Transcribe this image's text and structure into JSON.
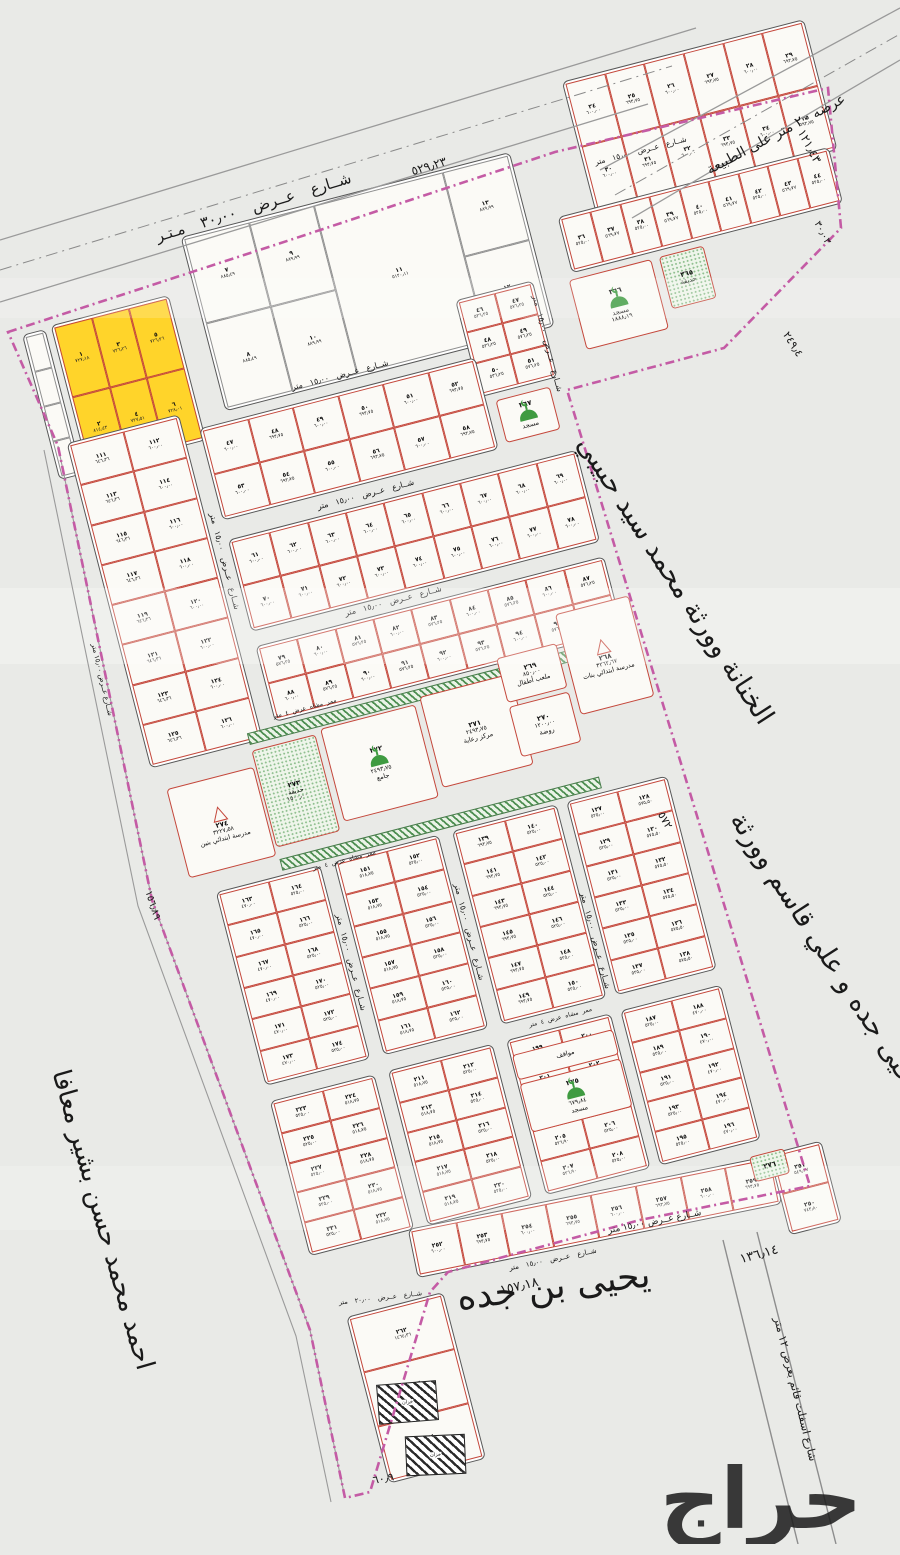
{
  "map": {
    "street30": "شــارع عــرض ٣٠٫٠٠ مـتـر",
    "street30_len": "٥٢٩٫٢٣",
    "street15": "شــارع عــرض ١٥٫٠٠ متر",
    "street20": "شــارع عــرض ٢٠٫٠٠ متر",
    "nature_road": "عرضه ٢٠ متر على الطبيعة",
    "asphalt_road": "شارع اسفلت قائم بعرض ١٢ متر",
    "walkway": "ممر مشاه عرض ٤ متر",
    "owner_right_1": "الخنانة وورثة محمد سيد حبيبي",
    "owner_right_2": "ويحيى جده و علي قاسم وورثة",
    "owner_left": "احمد محمد حسن بشير معافا",
    "owner_bottom": "يحيى بن جده",
    "len_121": "١٢١٫٤٣",
    "len_30": "٣٠٫٠٣",
    "len_249": "٢٤٩٫٤",
    "len_572": "٥٧٢",
    "len_136": "١٣٦٫١٤",
    "len_157": "١٥٧٫١٨",
    "len_60": "٦٠٫٩",
    "len_156": "١٥٦٫٨٩",
    "watermark": "حراج",
    "boundary_color": "#c45ba5",
    "plot_line_color": "#c4473b",
    "yellow_color": "#ffd42a",
    "green_color": "#3f9b41"
  },
  "facilities": {
    "school_boys": {
      "num": "٢٧٤",
      "area": "٣٢٢٧٫٥٨",
      "label": "مدرسة ابتدائي بنين"
    },
    "school_girls": {
      "num": "٢٦٨",
      "area": "٣٢٦٢٫٦٧",
      "label": "مدرسة ابتدائي بنات"
    },
    "park": {
      "num": "٢٧٣",
      "area": "١٥٠٠٫٠٠",
      "label": "حديقة"
    },
    "jame": {
      "num": "٢٧٢",
      "area": "٢٤٩٣٫٧٥",
      "label": "جامع"
    },
    "care": {
      "num": "٢٧١",
      "area": "٢٤٩٣٫٧٥",
      "label": "مركز رعاية"
    },
    "playground": {
      "num": "٢٦٩",
      "area": "٨٥٠٫٠٠",
      "label": "ملعب أطفال"
    },
    "kindergarten": {
      "num": "٢٧٠",
      "area": "١٢٠٠٫٠٠",
      "label": "روضة"
    },
    "mosque_366": {
      "num": "٣٦٦",
      "area": "١٨٨٨٫١٩",
      "label": "مسجد"
    },
    "mosque_367": {
      "num": "٣٦٧",
      "area": "٦٢٥٫٠٠",
      "label": "مسجد"
    },
    "mosque_275": {
      "num": "٢٧٥",
      "area": "٦٧٩٫٨٤",
      "label": "مسجد"
    },
    "parking": {
      "num": "",
      "area": "",
      "label": "مواقف"
    },
    "green_365": {
      "num": "٣٦٥",
      "area": "",
      "label": "حديقة"
    },
    "green_276": {
      "num": "٢٧٦",
      "area": "",
      "label": ""
    },
    "tank": {
      "label": "خزان"
    }
  },
  "blocks": {
    "edge": {
      "cols": 1,
      "list": [
        {
          "n": "",
          "a": ""
        },
        {
          "n": "",
          "a": ""
        },
        {
          "n": "",
          "a": ""
        },
        {
          "n": "",
          "a": ""
        }
      ]
    },
    "yellow": {
      "cols": 3,
      "list": [
        {
          "n": "١",
          "a": "٧٢٧٫١٨"
        },
        {
          "n": "٣",
          "a": "٧٢٦٫٢٦"
        },
        {
          "n": "٥",
          "a": "٧٢٦٫٢٦"
        },
        {
          "n": "٢",
          "a": "٨١٤٫٤٣"
        },
        {
          "n": "٤",
          "a": "٧٢٧٫٥١"
        },
        {
          "n": "٦",
          "a": "٧٢٨٫٠١"
        }
      ]
    },
    "b7": {
      "cols": 5,
      "list": [
        {
          "n": "٧",
          "a": "٨٨٥٫٤٩"
        },
        {
          "n": "٩",
          "a": "٨٨٩٫٩٩"
        },
        {
          "n": "١١",
          "a": "٥١٢٠٫١١",
          "c": 2,
          "r": 2
        },
        {
          "n": "١٣",
          "a": "٨٨٩٫٩٩"
        },
        {
          "n": "٨",
          "a": "٨٨٥٫٤٩"
        },
        {
          "n": "١٠",
          "a": "٨٨٩٫٩٩"
        },
        {
          "n": "١٢",
          "a": "٨٨٩٫٩٩"
        }
      ]
    },
    "b24": {
      "cols": 6,
      "from": 24,
      "to": 35,
      "area": "٦٠٠٫٠٠",
      "alt": "٦٩٣٫٧٥"
    },
    "b36": {
      "cols": 9,
      "from": 36,
      "to": 44,
      "area": "٥٢٥٫٠٠",
      "alt": "٥٦٩٫٧٧"
    },
    "b46": {
      "cols": 2,
      "from": 46,
      "to": 51,
      "area": "٥٣٦٫٢٥",
      "alt": "٥٧٦٫٢٥"
    },
    "sA": {
      "cols": 6,
      "from": 47,
      "to": 58,
      "area": "٦٩٣٫٧٥",
      "alt": "٦٠٠٫٠٠"
    },
    "sB": {
      "cols": 9,
      "from": 61,
      "to": 78,
      "area": "٦٠٠٫٠٠"
    },
    "sD": {
      "cols": 9,
      "from": 79,
      "to": 96,
      "area": "٦٠٠٫٠٠",
      "alt": "٥٧٦٫٢٥"
    },
    "tallL": {
      "cols": 2,
      "from": 111,
      "to": 126,
      "area": "٦٠٠٫٠٠",
      "alt": "٦٤٦٫٣٦"
    },
    "c1a": {
      "cols": 2,
      "from": 163,
      "to": 174,
      "area": "٥٢٥٫٠٠",
      "alt": "٤٧٠٫٠٠"
    },
    "c2a": {
      "cols": 2,
      "from": 151,
      "to": 162,
      "area": "٥٢٥٫٠٠",
      "alt": "٥١٨٫٧٥"
    },
    "c3a": {
      "cols": 2,
      "from": 139,
      "to": 150,
      "area": "٥٢٥٫٠٠",
      "alt": "٦٩٣٫٧٥"
    },
    "c4a": {
      "cols": 2,
      "from": 127,
      "to": 138,
      "area": "٥٧٥٫٥٠",
      "alt": "٥٢٥٫٠٠"
    },
    "c1b": {
      "cols": 2,
      "from": 223,
      "to": 232,
      "area": "٥١٨٫٧٥",
      "alt": "٥٢٥٫٠٠"
    },
    "c2b": {
      "cols": 2,
      "from": 211,
      "to": 220,
      "area": "٥٢٥٫٠٠",
      "alt": "٥١٨٫٧٥"
    },
    "c3b": {
      "cols": 2,
      "from": 199,
      "to": 208,
      "area": "٥٢٥٫٠٠",
      "alt": "٥٢٦٫٩٠"
    },
    "c4b": {
      "cols": 2,
      "from": 187,
      "to": 196,
      "area": "٤٧٠٫٠٠",
      "alt": "٥٢٥٫٠٠"
    },
    "sH": {
      "cols": 8,
      "from": 252,
      "to": 259,
      "area": "٦٠٠٫٠٠",
      "alt": "٦٩٣٫٧٥"
    },
    "b250": {
      "cols": 1,
      "list": [
        {
          "n": "٢٥١",
          "a": "٥٤٩٫٣٧"
        },
        {
          "n": "٢٥٠",
          "a": "٧٤٣٫٨٠"
        }
      ]
    },
    "bigTail": {
      "cols": 1,
      "list": [
        {
          "n": "٢٦٢",
          "a": "١٤٦٤٫٣٦"
        },
        {
          "n": "٢٦٣",
          "a": "١٦١٢٫٥٢"
        },
        {
          "n": "٢٦٤",
          "a": "١٥٣٨٫٩٨"
        }
      ]
    }
  }
}
